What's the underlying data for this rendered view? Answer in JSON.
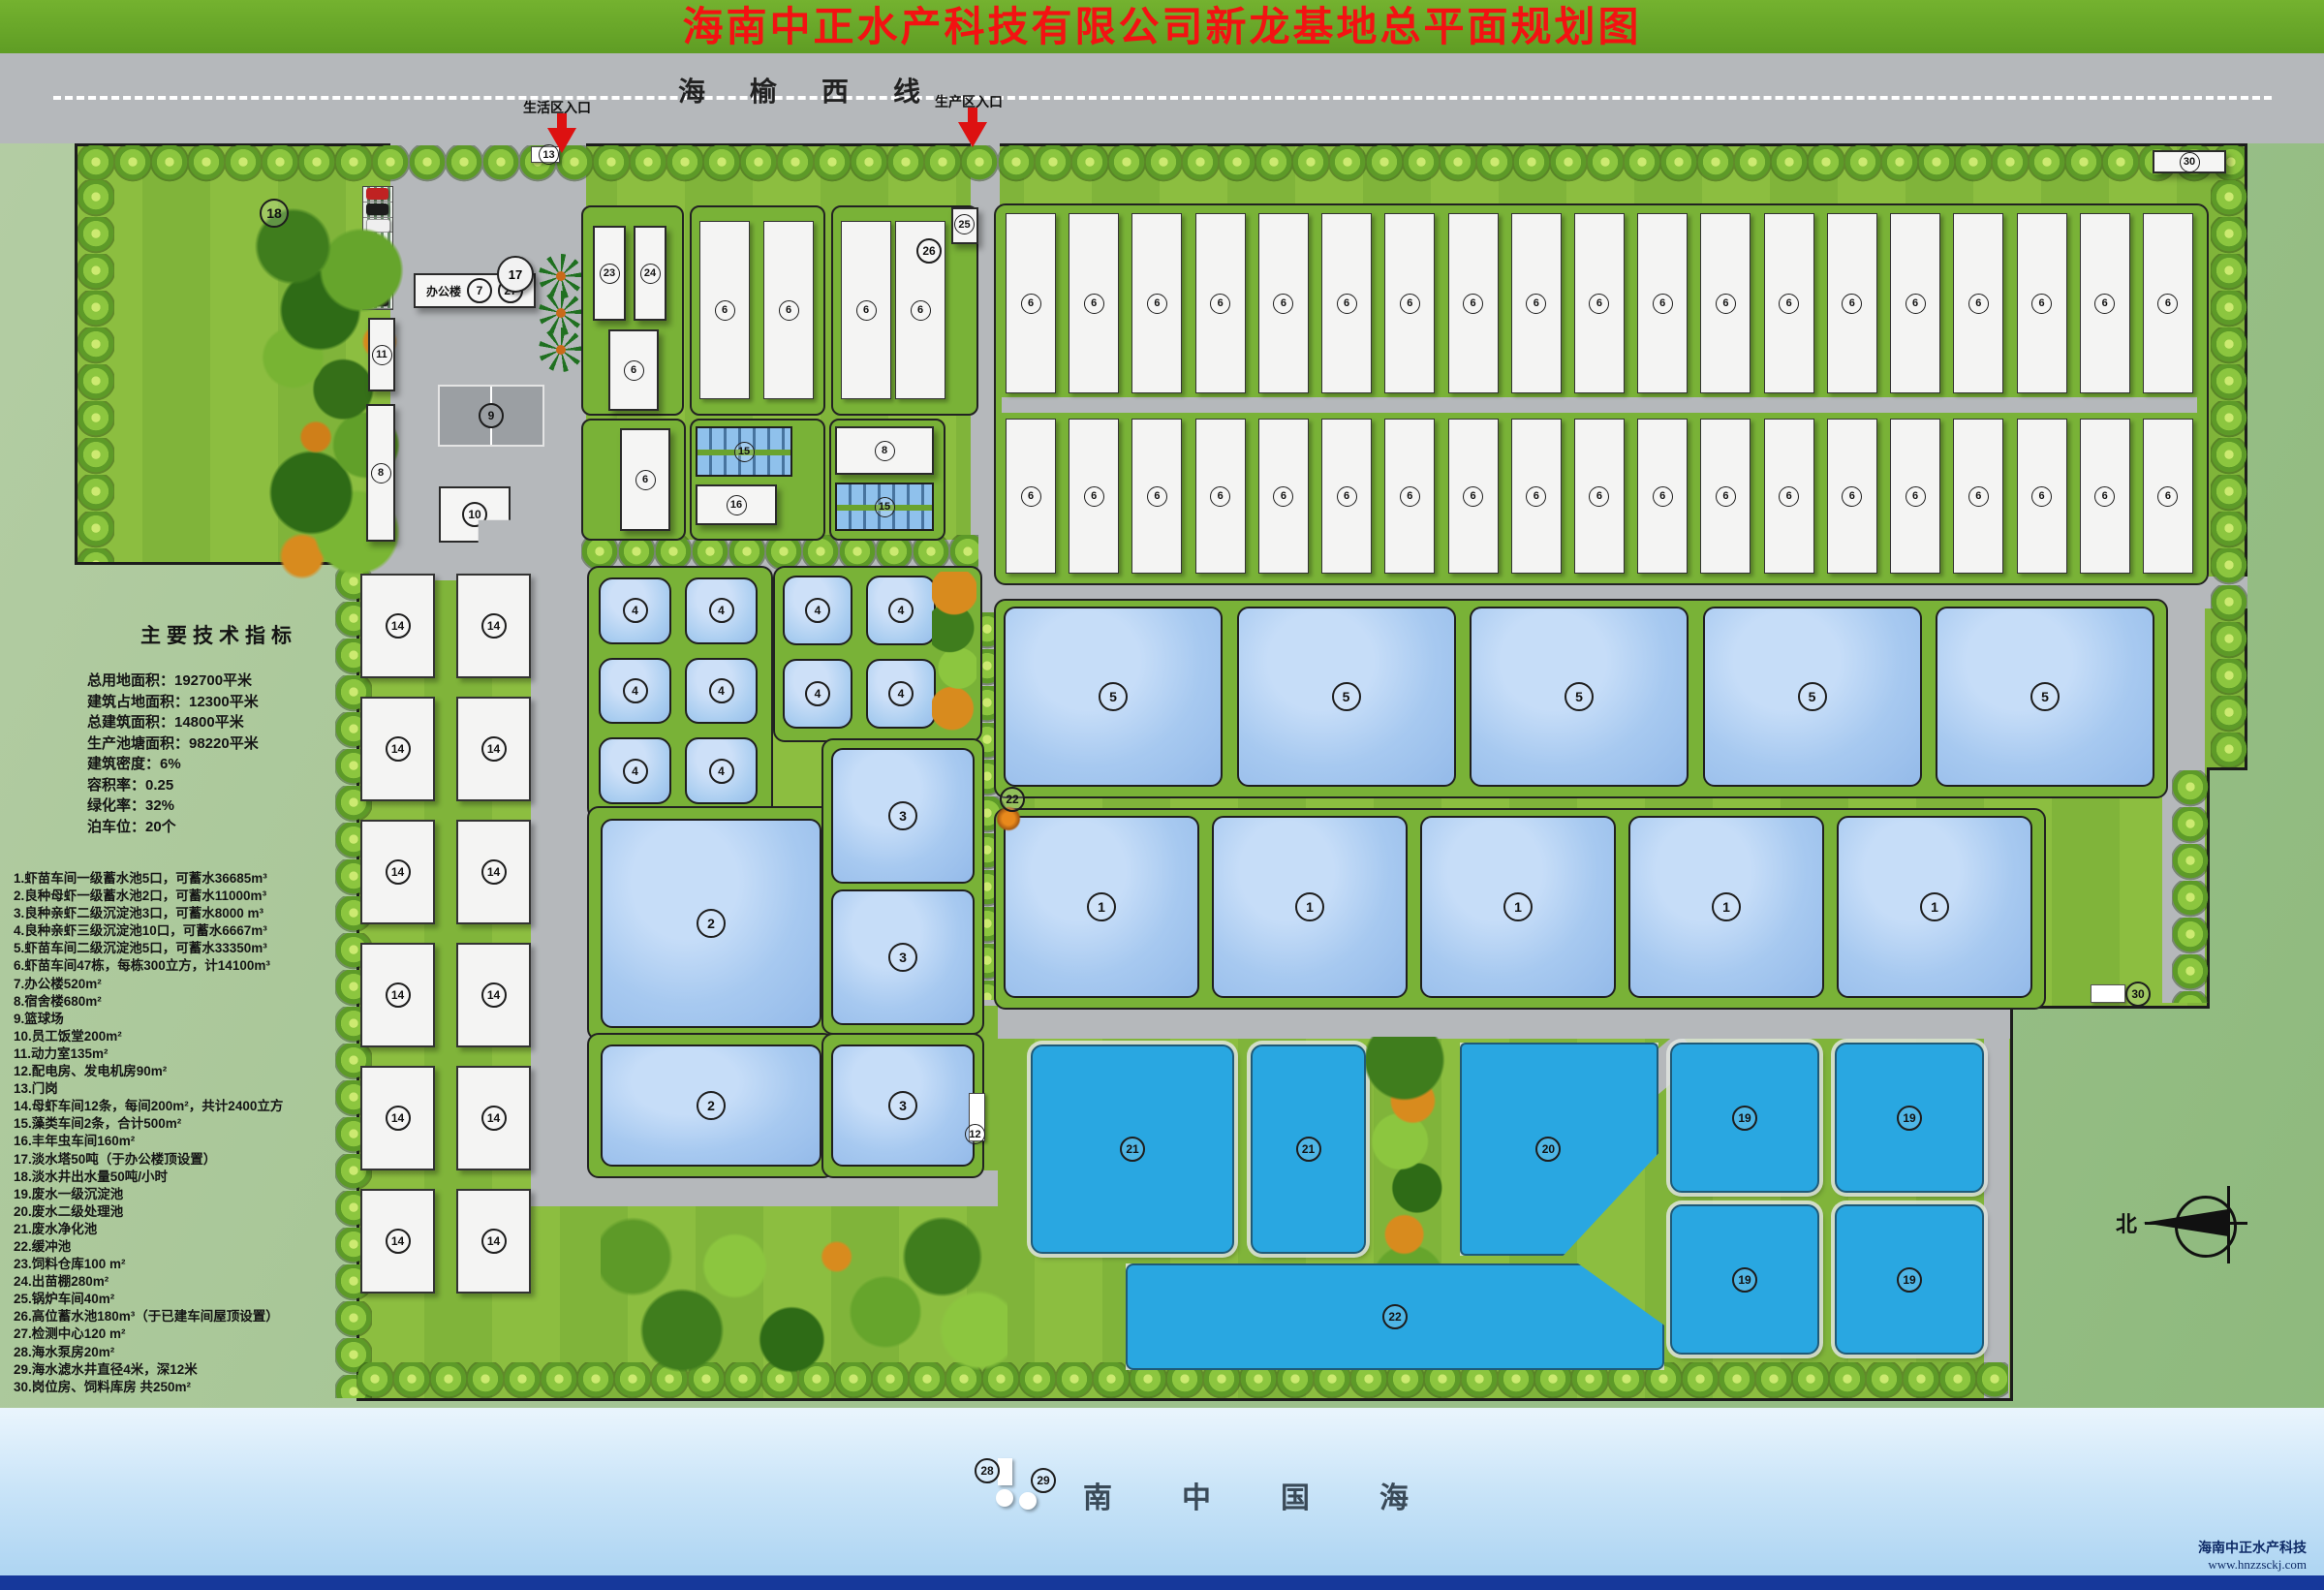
{
  "title": "海南中正水产科技有限公司新龙基地总平面规划图",
  "road": {
    "name": "海榆西线",
    "entrance_left": "生活区入口",
    "entrance_right": "生产区入口"
  },
  "sea": {
    "name": "南中国海"
  },
  "watermark": {
    "company": "海南中正水产科技",
    "url": "www.hnzzsckj.com"
  },
  "compass": {
    "north": "北"
  },
  "office": {
    "label": "办公楼"
  },
  "indicators": {
    "title": "主要技术指标",
    "lines": [
      "总用地面积：192700平米",
      "建筑占地面积：12300平米",
      "总建筑面积：14800平米",
      "生产池塘面积：98220平米",
      "建筑密度：6%",
      "容积率：0.25",
      "绿化率：32%",
      "泊车位：20个"
    ]
  },
  "legend": {
    "items": [
      "1.虾苗车间一级蓄水池5口，可蓄水36685m³",
      "2.良种母虾一级蓄水池2口，可蓄水11000m³",
      "3.良种亲虾二级沉淀池3口，可蓄水8000 m³",
      "4.良种亲虾三级沉淀池10口，可蓄水6667m³",
      "5.虾苗车间二级沉淀池5口，可蓄水33350m³",
      "6.虾苗车间47栋，每栋300立方，计14100m³",
      "7.办公楼520m²",
      "8.宿舍楼680m²",
      "9.篮球场",
      "10.员工饭堂200m²",
      "11.动力室135m²",
      "12.配电房、发电机房90m²",
      "13.门岗",
      "14.母虾车间12条，每间200m²，共计2400立方",
      "15.藻类车间2条，合计500m²",
      "16.丰年虫车间160m²",
      "17.淡水塔50吨（于办公楼顶设置）",
      "18.淡水井出水量50吨/小时",
      "19.废水一级沉淀池",
      "20.废水二级处理池",
      "21.废水净化池",
      "22.缓冲池",
      "23.饲料仓库100 m²",
      "24.出苗棚280m²",
      "25.锅炉车间40m²",
      "26.高位蓄水池180m³（于已建车间屋顶设置）",
      "27.检测中心120 m²",
      "28.海水泵房20m²",
      "29.海水滤水井直径4米，深12米",
      "30.岗位房、饲料库房 共250m²"
    ]
  },
  "markers": {
    "gate13": "13",
    "trees18": "18",
    "tower17": "17",
    "office7": "7",
    "office27": "27",
    "power11": "11",
    "dorm8": "8",
    "court9": "9",
    "canteen10": "10",
    "b23": "23",
    "b24": "24",
    "b25": "25",
    "b26": "26",
    "b6a": "6",
    "b6b": "6",
    "p15a": "15",
    "b16": "16",
    "b8b": "8",
    "p15b": "15",
    "p2a": "2",
    "p3a": "3",
    "p3b": "3",
    "p2b": "2",
    "p3c": "3",
    "sub12": "12",
    "buffer22": "22",
    "outlet30": "30",
    "bld30": "30",
    "p21a": "21",
    "p21b": "21",
    "p20": "20",
    "p22": "22",
    "pump28": "28",
    "filter29": "29"
  },
  "upper": {
    "pairB": {
      "count": 2,
      "label": "6"
    },
    "pairC": {
      "count": 2,
      "label": "6"
    }
  },
  "grids": {
    "field_row1": {
      "count": 19,
      "label": "6"
    },
    "field_row2": {
      "count": 19,
      "label": "6"
    },
    "ponds5": {
      "count": 5,
      "label": "5"
    },
    "ponds1": {
      "count": 5,
      "label": "1"
    },
    "pools4a": {
      "count": 6,
      "label": "4"
    },
    "pools4b": {
      "count": 4,
      "label": "4"
    },
    "b14": {
      "count": 12,
      "label": "14"
    },
    "p19": {
      "count": 4,
      "label": "19"
    }
  }
}
